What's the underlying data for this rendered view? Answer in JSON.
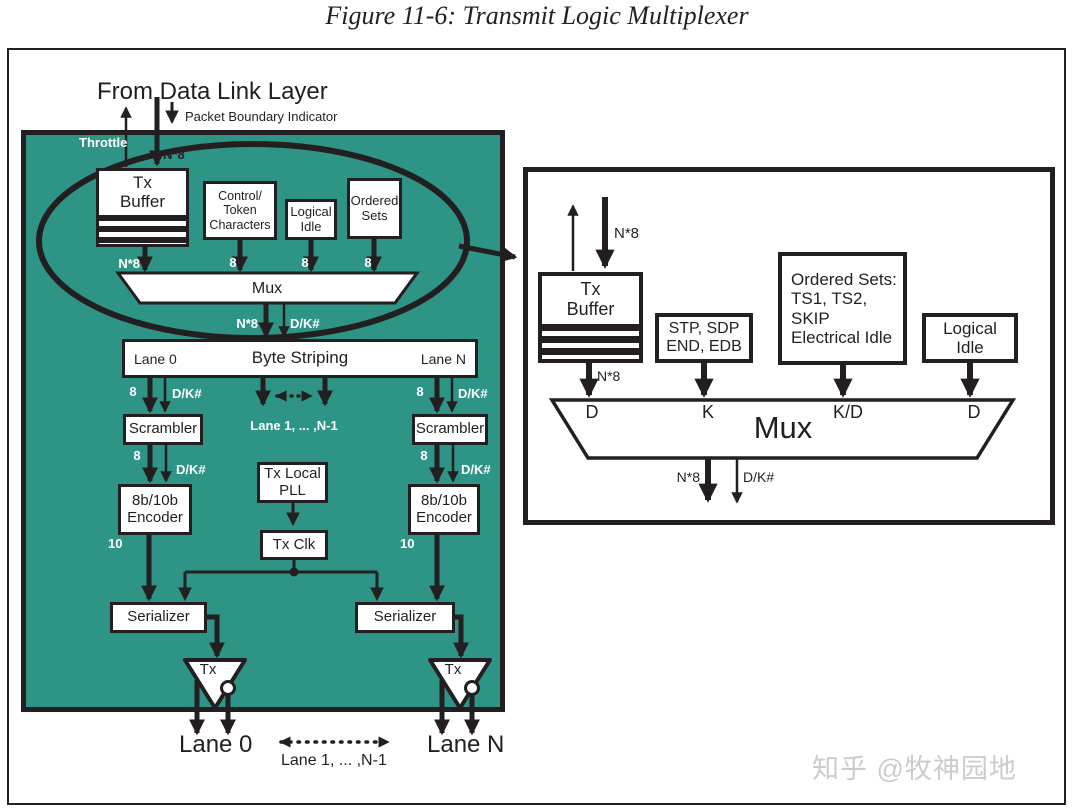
{
  "figure_title": "Figure 11-6: Transmit Logic Multiplexer",
  "colors": {
    "panel_teal": "#2e9486",
    "ink": "#231f20",
    "watermark_gray": "#cccccc"
  },
  "main_panel": {
    "from_data_link_layer": "From Data Link Layer",
    "packet_boundary_indicator": "Packet Boundary Indicator",
    "throttle": "Throttle",
    "bus_n8": "N*8",
    "bus_8": "8",
    "bus_10": "10",
    "bus_dk": "D/K#",
    "tx_buffer": "Tx\nBuffer",
    "control_token": "Control/\nToken\nCharacters",
    "logical_idle": "Logical\nIdle",
    "ordered_sets": "Ordered\nSets",
    "mux": "Mux",
    "byte_striping": "Byte Striping",
    "lane_0": "Lane 0",
    "lane_n": "Lane N",
    "lane_mid": "Lane 1, ... ,N-1",
    "scrambler": "Scrambler",
    "encoder_8b10b": "8b/10b\nEncoder",
    "tx_local_pll": "Tx Local\nPLL",
    "tx_clk": "Tx Clk",
    "serializer": "Serializer",
    "tx": "Tx"
  },
  "detail_panel": {
    "bus_n8": "N*8",
    "bus_dk": "D/K#",
    "tx_buffer": "Tx\nBuffer",
    "stp_sdp_end_edb": "STP, SDP\nEND, EDB",
    "ordered_sets": "Ordered Sets:\nTS1, TS2,\nSKIP\nElectrical Idle",
    "logical_idle": "Logical\nIdle",
    "in_d1": "D",
    "in_k": "K",
    "in_kd": "K/D",
    "in_d2": "D",
    "mux": "Mux"
  },
  "watermark": "知乎 @牧神园地"
}
